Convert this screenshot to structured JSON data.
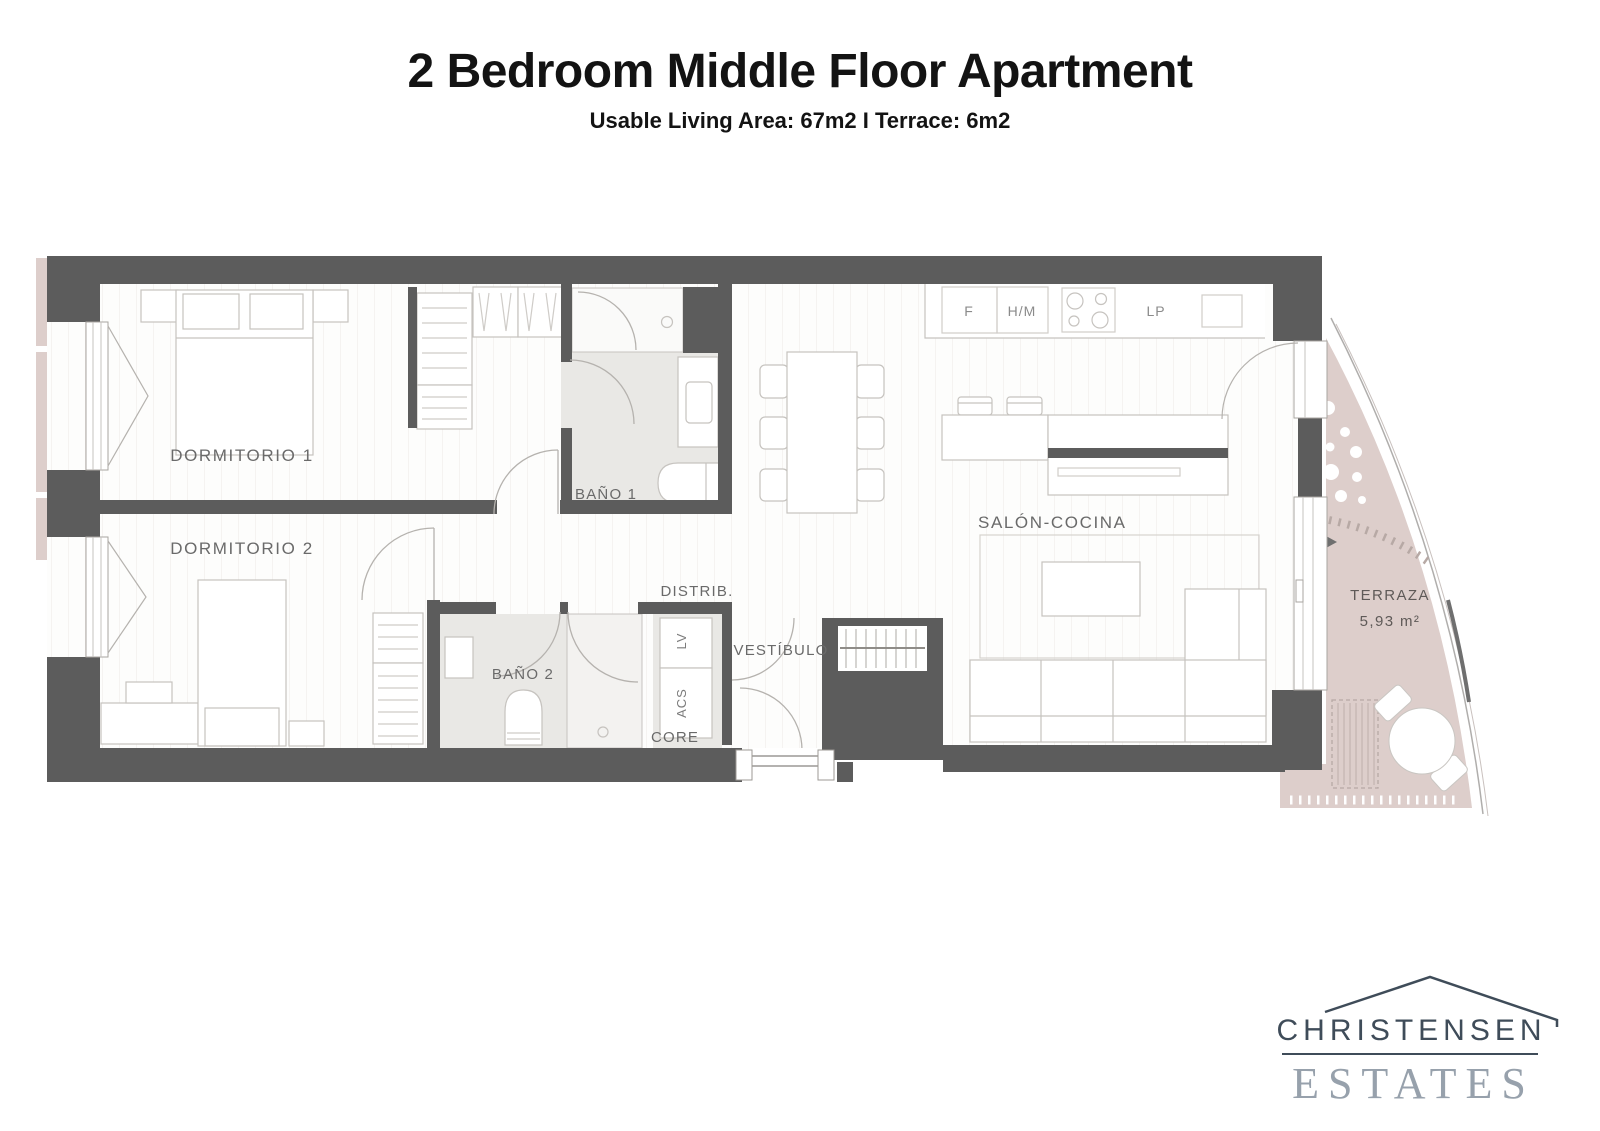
{
  "header": {
    "title": "2 Bedroom Middle Floor Apartment",
    "subtitle": "Usable Living Area: 67m2 I Terrace: 6m2"
  },
  "plan": {
    "rooms": {
      "dormitorio1": "DORMITORIO 1",
      "dormitorio2": "DORMITORIO 2",
      "bano1": "BAÑO 1",
      "bano2": "BAÑO 2",
      "distrib": "DISTRIB.",
      "vestibulo": "VESTÍBULO",
      "salon_cocina": "SALÓN-COCINA",
      "core": "CORE"
    },
    "terrace": {
      "label": "TERRAZA",
      "area": "5,93 m²"
    },
    "kitchen": {
      "f": "F",
      "hm": "H/M",
      "lp": "LP"
    },
    "utility": {
      "lv": "LV",
      "acs": "ACS"
    },
    "colors": {
      "wall": "#5c5c5c",
      "bath_floor": "#e9e8e5",
      "terrace": "#ddcecb",
      "furniture_stroke": "#c6c3bf",
      "label": "#6a6a6a"
    }
  },
  "logo": {
    "name": "CHRISTENSEN",
    "word2": "ESTATES",
    "roof_icon": "roof-outline"
  }
}
